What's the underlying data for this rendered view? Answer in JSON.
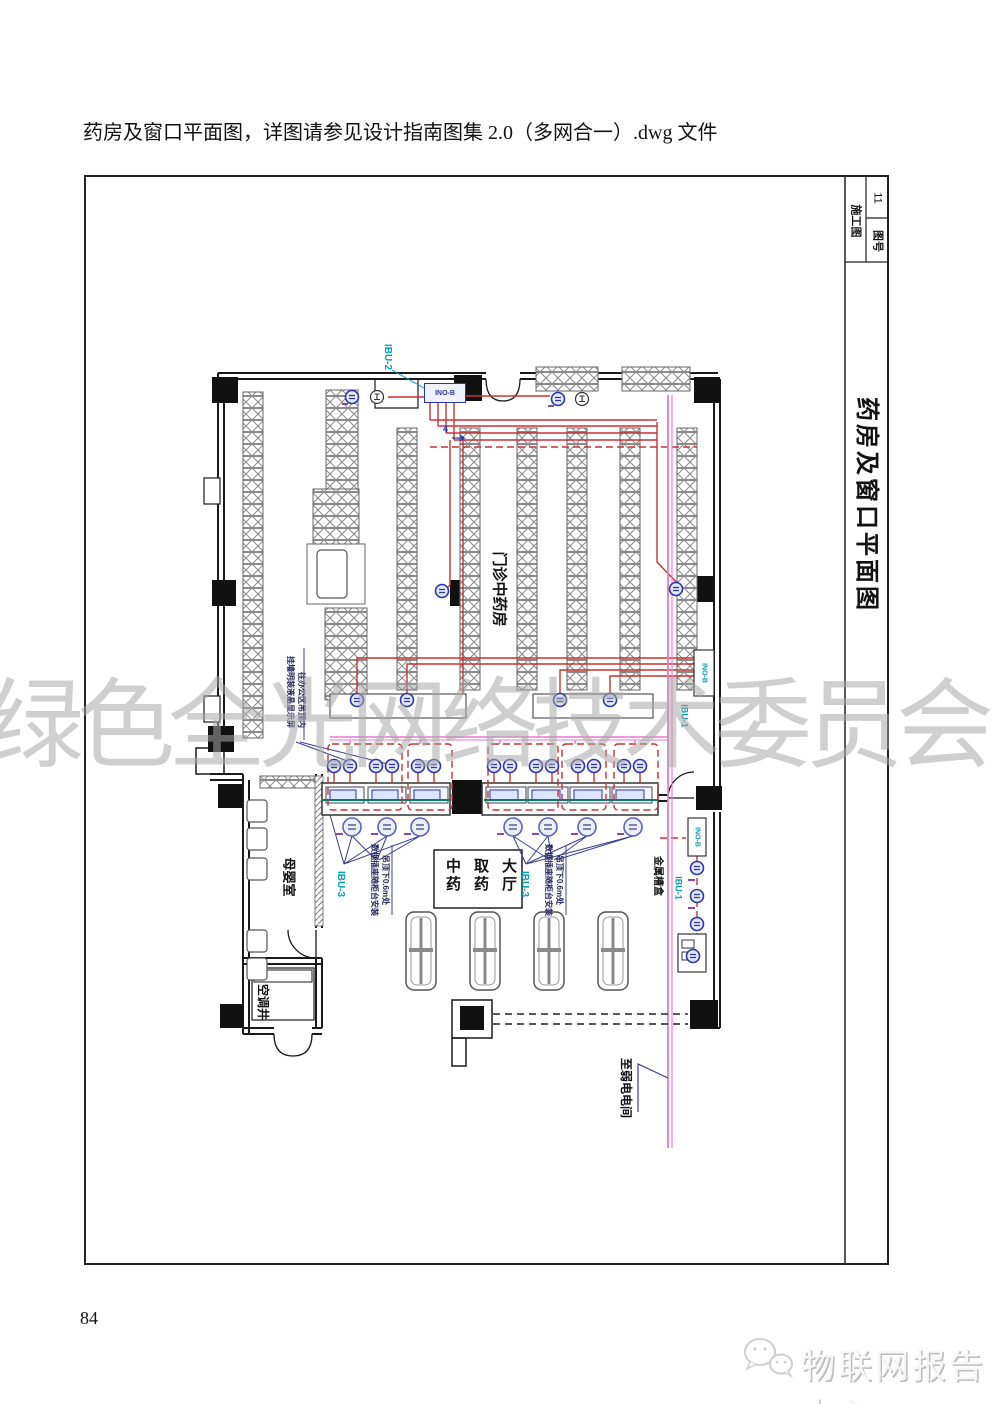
{
  "page": {
    "caption": "药房及窗口平面图，详图请参见设计指南图集 2.0（多网合一）.dwg 文件",
    "page_number": "84",
    "watermark": "绿色全光网络技术委员会"
  },
  "footer": {
    "brand": "物联网报告中心",
    "icon": "wechat-bubbles-icon"
  },
  "title_block": {
    "stage": "施工图",
    "sheet_label": "图号",
    "sheet_number": "11",
    "drawing_title": "药房及窗口平面图"
  },
  "plan": {
    "rooms": {
      "pharmacy": "门诊中药房",
      "hall_cols": [
        "中药",
        "取药",
        "大厅"
      ],
      "nursing_room": "母婴室",
      "ac_shaft": "空调井"
    },
    "labels": {
      "ibu2": "IBU-2",
      "ibu3": "IBU-3",
      "ibu1": "IBU-1",
      "ino_b": "INO-B",
      "cable_tray": "金属槽盒",
      "to_weak_room": "至弱电电间",
      "riser_count": "4"
    },
    "annotations": {
      "wall_display": [
        "挂墙明装液晶显示屏",
        "往办公区吊顶内"
      ],
      "counter_outlet": [
        "数据插座随柜台安装",
        "吊顶下0.6m处"
      ]
    },
    "colors": {
      "cable_red": "#c83232",
      "trunk_pink": "#ee77cc",
      "device_blue": "#2a35b0",
      "label_cyan": "#00a0b0",
      "counter_teal": "#0b7b68",
      "fan_navy": "#3a3f8f"
    }
  }
}
